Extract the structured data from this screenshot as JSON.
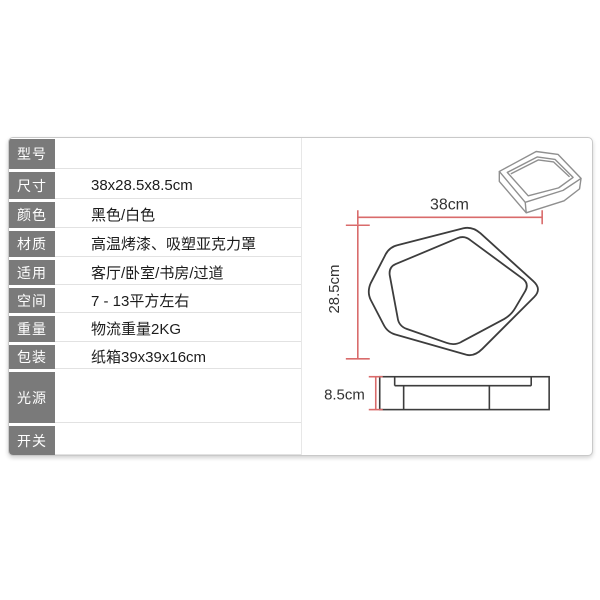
{
  "spec_table": {
    "rows": [
      {
        "label": "型号",
        "value": ""
      },
      {
        "label": "尺寸",
        "value": "38x28.5x8.5cm"
      },
      {
        "label": "颜色",
        "value": "黑色/白色"
      },
      {
        "label": "材质",
        "value": "高温烤漆、吸塑亚克力罩"
      },
      {
        "label": "适用",
        "value": "客厅/卧室/书房/过道"
      },
      {
        "label": "空间",
        "value": "7 - 13平方左右"
      },
      {
        "label": "重量",
        "value": "物流重量2KG"
      },
      {
        "label": "包装",
        "value": "纸箱39x39x16cm"
      },
      {
        "label": "光源",
        "value": ""
      },
      {
        "label": "开关",
        "value": ""
      }
    ]
  },
  "diagram": {
    "width_label": "38cm",
    "depth_label": "28.5cm",
    "height_label": "8.5cm"
  },
  "colors": {
    "label_bg": "#7a7a7a",
    "dimension_line": "#d96b6b",
    "drawing_outline": "#3d3d3d",
    "sketch_outline": "#8f8f8f",
    "panel_border": "#c9c9c9"
  }
}
